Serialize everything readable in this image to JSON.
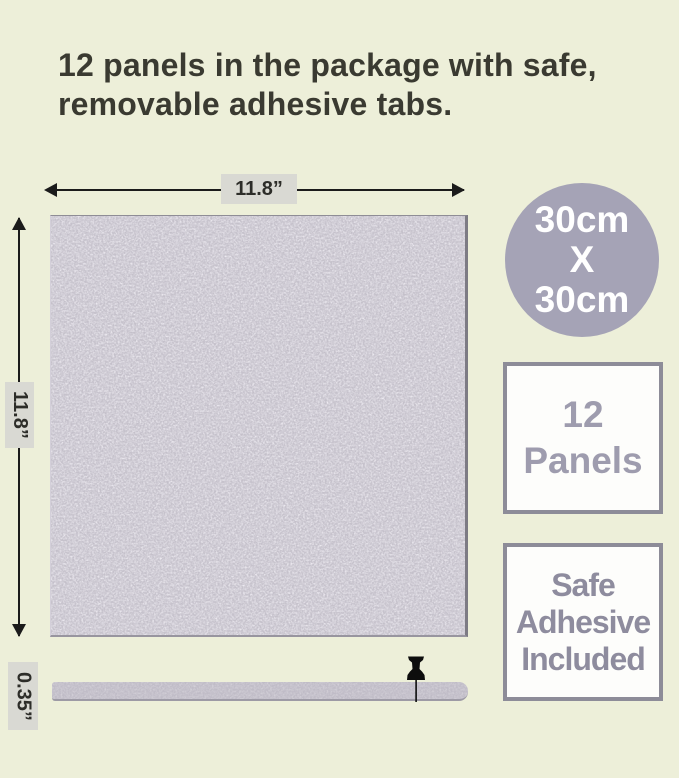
{
  "header": {
    "title": "12 panels in the package with safe, removable adhesive tabs."
  },
  "diagram": {
    "top_width_label": "11.8”",
    "left_height_label": "11.8”",
    "thickness_label": "0.35”"
  },
  "badges": {
    "size_circle": {
      "line1": "30cm",
      "line2": "X",
      "line3": "30cm"
    },
    "panel_count_box": {
      "line1": "12",
      "line2": "Panels"
    },
    "adhesive_box": {
      "line1": "Safe",
      "line2": "Adhesive",
      "line3": "Included"
    }
  },
  "icons": {
    "pushpin": "pushpin-icon",
    "arrowheads": [
      "arrowhead-left-icon",
      "arrowhead-right-icon",
      "arrowhead-up-icon",
      "arrowhead-down-icon"
    ]
  },
  "colors": {
    "background": "#edefd9",
    "title_text": "#3a3a31",
    "panel_felt": "#c4c0ca",
    "circle_badge": "#a5a3b6",
    "box_border": "#8d8c98",
    "panels_box_text": "#9e9cae",
    "adhesive_box_text": "#8e8c9e",
    "dimension_label_bg": "#d9d9d3",
    "dimension_line": "#1b1b1b",
    "pushpin": "#0d0d0d"
  }
}
